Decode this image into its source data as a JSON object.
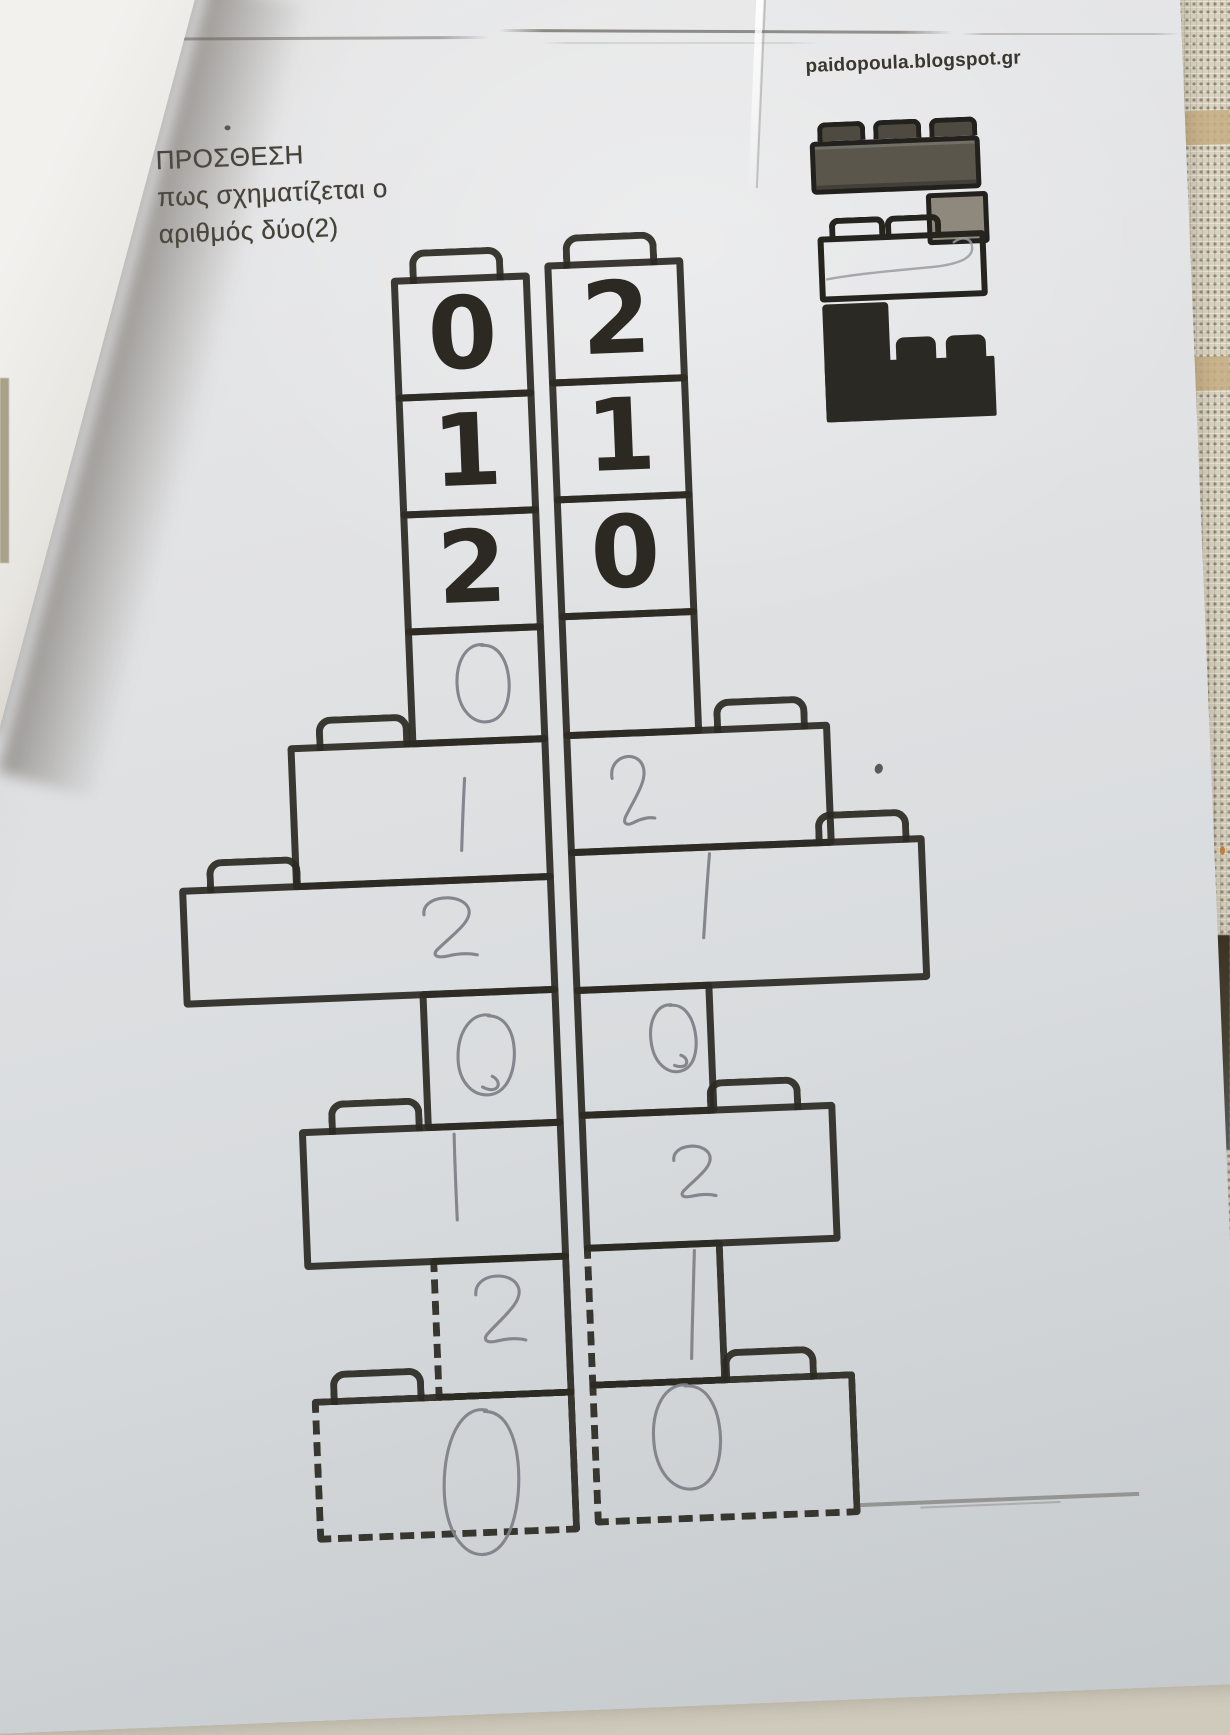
{
  "photo": {
    "watermark_url": "paidopoula.blogspot.gr",
    "title_lines": [
      "ΠΡΟΣΘΕΣΗ",
      "πως σχηματίζεται ο",
      "αριθμός  δύο(2)"
    ]
  },
  "towers": {
    "left": {
      "bricks": [
        {
          "kind": "printed",
          "digit": "0"
        },
        {
          "kind": "printed",
          "digit": "1"
        },
        {
          "kind": "printed",
          "digit": "2"
        },
        {
          "kind": "handwritten",
          "digit": "0"
        },
        {
          "kind": "handwritten",
          "digit": "1"
        },
        {
          "kind": "handwritten",
          "digit": "2"
        },
        {
          "kind": "handwritten",
          "digit": "0"
        },
        {
          "kind": "handwritten",
          "digit": "1"
        },
        {
          "kind": "handwritten",
          "digit": "2"
        },
        {
          "kind": "handwritten",
          "digit": "0"
        }
      ]
    },
    "right": {
      "bricks": [
        {
          "kind": "printed",
          "digit": "2"
        },
        {
          "kind": "printed",
          "digit": "1"
        },
        {
          "kind": "printed",
          "digit": "0"
        },
        {
          "kind": "empty",
          "digit": ""
        },
        {
          "kind": "handwritten",
          "digit": "2"
        },
        {
          "kind": "handwritten",
          "digit": "1"
        },
        {
          "kind": "handwritten",
          "digit": "0"
        },
        {
          "kind": "handwritten",
          "digit": "2"
        },
        {
          "kind": "handwritten",
          "digit": "1"
        },
        {
          "kind": "handwritten",
          "digit": "0"
        }
      ]
    }
  },
  "colors": {
    "print_ink": "#2c2a23",
    "pencil": "#81818a",
    "paper": "#dfe0e2",
    "fabric": "#d9d2c0",
    "dark_patch": "#3e3322"
  }
}
